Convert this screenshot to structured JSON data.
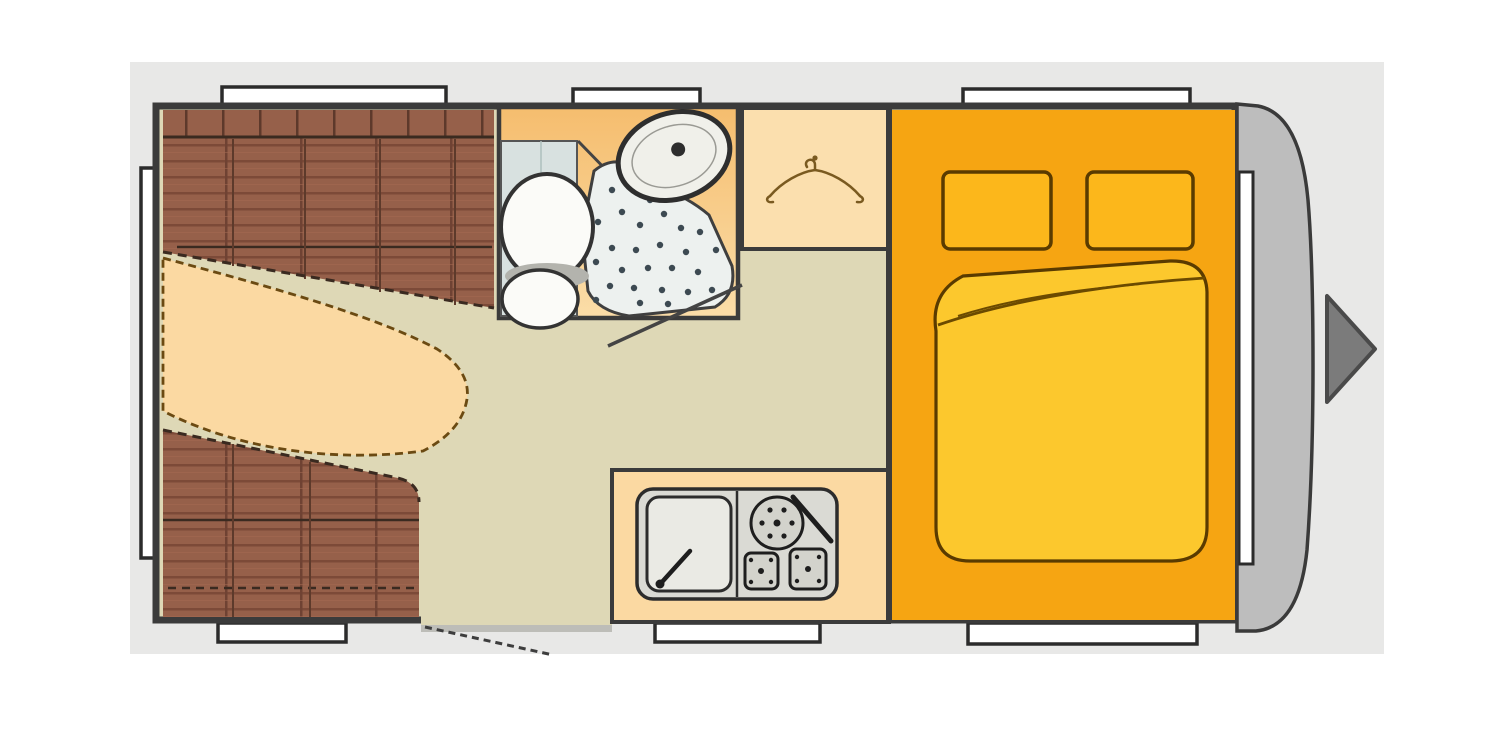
{
  "floorplan": {
    "kind": "caravan-floor-plan",
    "areas": [
      "dinette-lounge",
      "bathroom",
      "wardrobe",
      "kitchen",
      "bedroom"
    ],
    "fixtures": [
      "dinette-table",
      "bench-seat-top",
      "bench-seat-bottom",
      "toilet",
      "shower-tray",
      "washbasin",
      "clothes-hanger",
      "kitchen-sink",
      "hob-burners",
      "double-bed",
      "pillow-left",
      "pillow-right",
      "duvet",
      "entry-door",
      "front-cap",
      "direction-arrow"
    ],
    "window_count": 8
  },
  "colors": {
    "canvas": "#e8e8e7",
    "wall": "#3b3b3b",
    "floor": "#ded8b6",
    "seat": "#96604a",
    "seat_seam": "#7c4a38",
    "table": "#fbd9a2",
    "counter": "#fbd9a2",
    "wardrobe": "#fbdfae",
    "bath_top": "#f5bd6e",
    "bath_bottom": "#fbdda8",
    "shower_wall": "#d8e1e0",
    "shower_tray": "#edf1ef",
    "toilet": "#fbfbf8",
    "basin": "#f0f0ea",
    "bedroom": "#f6a512",
    "pillow": "#fcb71b",
    "duvet": "#fcc82d",
    "cap": "#bdbdbd",
    "arrow": "#7b7b7b",
    "window": "#ffffff",
    "unit": "#dadad4",
    "sink": "#eaeae4",
    "threshold": "#bdbdb8"
  }
}
